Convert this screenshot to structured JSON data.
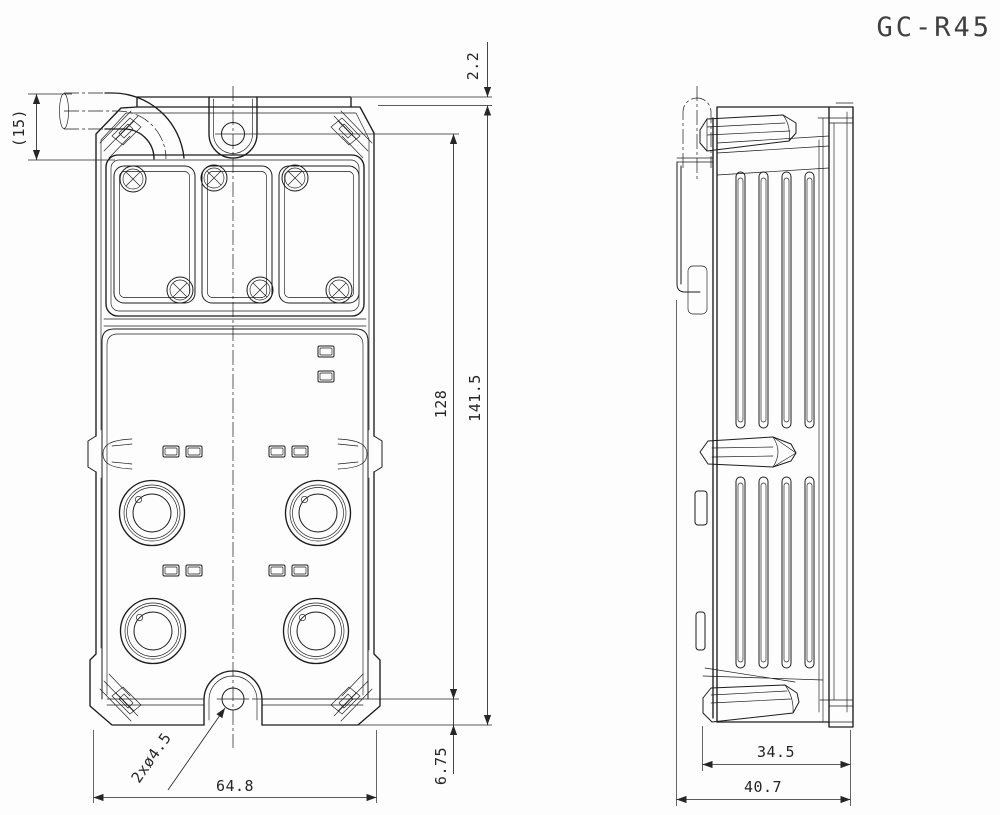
{
  "title": "GC-R45",
  "dimensions": {
    "cable_clearance": "(15)",
    "ear_offset": "2.2",
    "hole_pitch": "128",
    "overall_height": "141.5",
    "hole_to_base": "6.75",
    "overall_width": "64.8",
    "mounting_hole_note": "2xø4.5",
    "body_depth": "34.5",
    "overall_depth": "40.7"
  },
  "style": {
    "line_color": "#1c1c1c",
    "dim_color": "#262626",
    "title_color": "#3f3f3f",
    "background": "#fdfdfd"
  }
}
